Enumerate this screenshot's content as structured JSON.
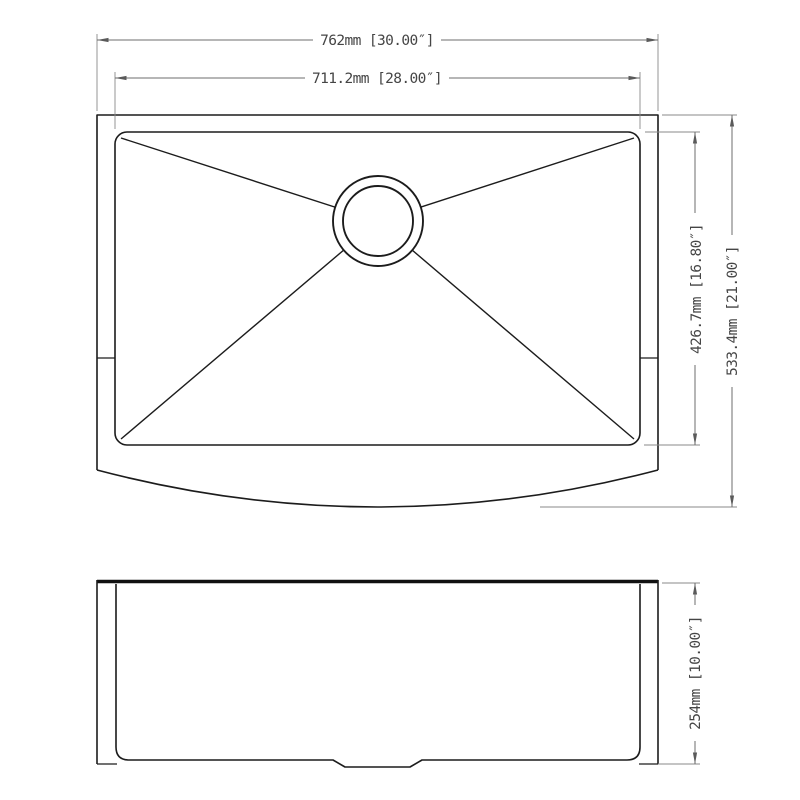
{
  "drawing": {
    "dimensions": {
      "overall_width": {
        "label": "762mm [30.00″]",
        "mm": "762",
        "inches": "30.00"
      },
      "inner_width": {
        "label": "711.2mm [28.00″]",
        "mm": "711.2",
        "inches": "28.00"
      },
      "inner_depth": {
        "label": "426.7mm [16.80″]",
        "mm": "426.7",
        "inches": "16.80"
      },
      "overall_depth": {
        "label": "533.4mm [21.00″]",
        "mm": "533.4",
        "inches": "21.00"
      },
      "apron_height": {
        "label": "254mm [10.00″]",
        "mm": "254",
        "inches": "10.00"
      }
    },
    "colors": {
      "background": "#ffffff",
      "object_line": "#1c1c1c",
      "dimension_line": "#6e6e6e",
      "extension_line": "#8a8a8a",
      "text": "#454545"
    }
  }
}
